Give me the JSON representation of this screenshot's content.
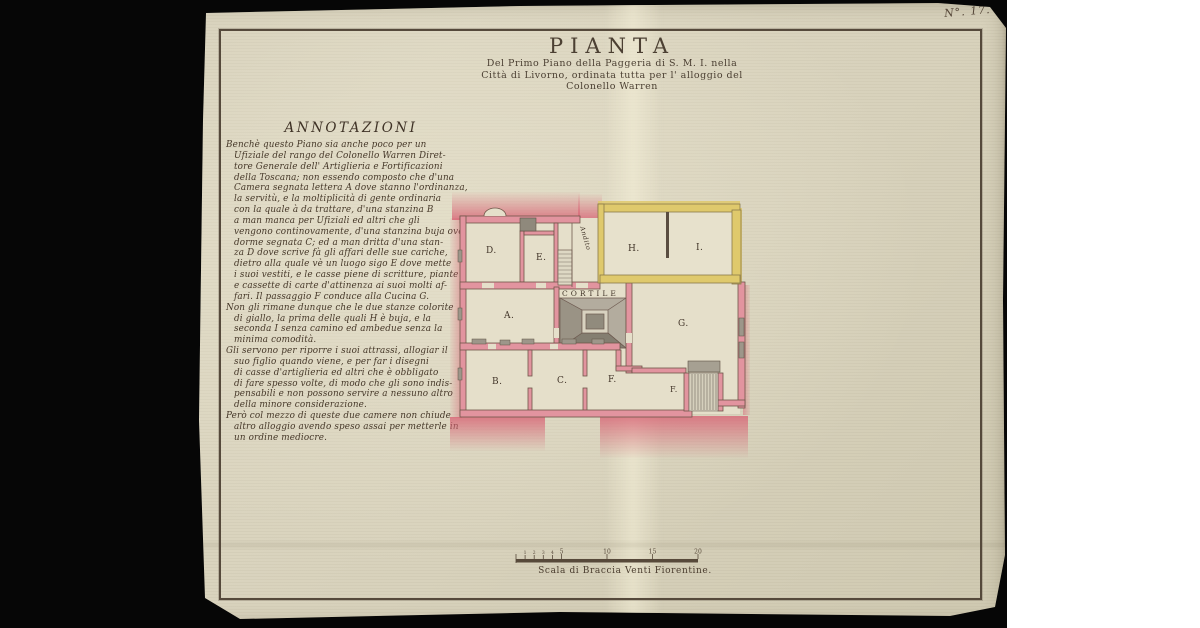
{
  "document": {
    "page_number": "N°. 17.",
    "title": "PIANTA",
    "subtitle_lines": [
      "Del Primo Piano della Paggeria di S. M. I. nella",
      "Città di Livorno, ordinata tutta per l' alloggio del",
      "Colonello Warren"
    ],
    "annotations": {
      "heading": "ANNOTAZIONI",
      "paragraph_starts": [
        0,
        15,
        19,
        25
      ],
      "lines": [
        "Benchè questo Piano sia anche poco per un",
        "Ufiziale del rango del Colonello Warren Diret-",
        "tore Generale dell' Artiglieria e Fortificazioni",
        "della Toscana; non essendo composto che d'una",
        "Camera segnata lettera A dove stanno l'ordinanza,",
        "la servitù, e la moltiplicità di gente ordinaria",
        "con la quale à da trattare, d'una stanzina B",
        "a man manca per Ufiziali ed altri che gli",
        "vengono continovamente, d'una stanzina buja ove",
        "dorme segnata C; ed a man dritta d'una stan-",
        "za D dove scrive fà gli affari delle sue cariche,",
        "dietro alla quale vè un luogo sigo E dove mette",
        "i suoi vestiti, e le casse piene di scritture, piante",
        "e cassette di carte d'attinenza ai suoi molti af-",
        "fari. Il passaggio F conduce alla Cucina G.",
        "Non gli rimane dunque che le due stanze colorite",
        "di giallo, la prima delle quali H è buja, e la",
        "seconda I senza camino ed ambedue senza la",
        "minima comodità.",
        "Gli servono per riporre i suoi attrassi, allogiar il",
        "suo figlio quando viene, e per far i disegni",
        "di casse d'artiglieria ed altri che è obbligato",
        "di fare spesso volte, di modo che gli sono indis-",
        "pensabili e non possono servire a nessuno altro",
        "della minore considerazione.",
        "Però col mezzo di queste due camere non chiude",
        "altro alloggio avendo speso assai per metterle in",
        "un ordine mediocre."
      ]
    },
    "plan": {
      "rooms": {
        "a": "A.",
        "b": "B.",
        "c": "C.",
        "d": "D.",
        "e": "E.",
        "f1": "F.",
        "f2": "F.",
        "g": "G.",
        "h": "H.",
        "i": "I."
      },
      "corridor_label": "Andito",
      "courtyard_label": "CORTILE"
    },
    "scale": {
      "caption": "Scala di Braccia Venti Fiorentine.",
      "minor_ticks": [
        "1",
        "2",
        "3",
        "4"
      ],
      "major_ticks": [
        "5",
        "10",
        "15",
        "20"
      ]
    },
    "colors": {
      "wall_pink": "#dd6b78",
      "room_yellow": "#dfc96c",
      "paper": "#d9d3be",
      "ink": "#4a3c2e"
    }
  }
}
